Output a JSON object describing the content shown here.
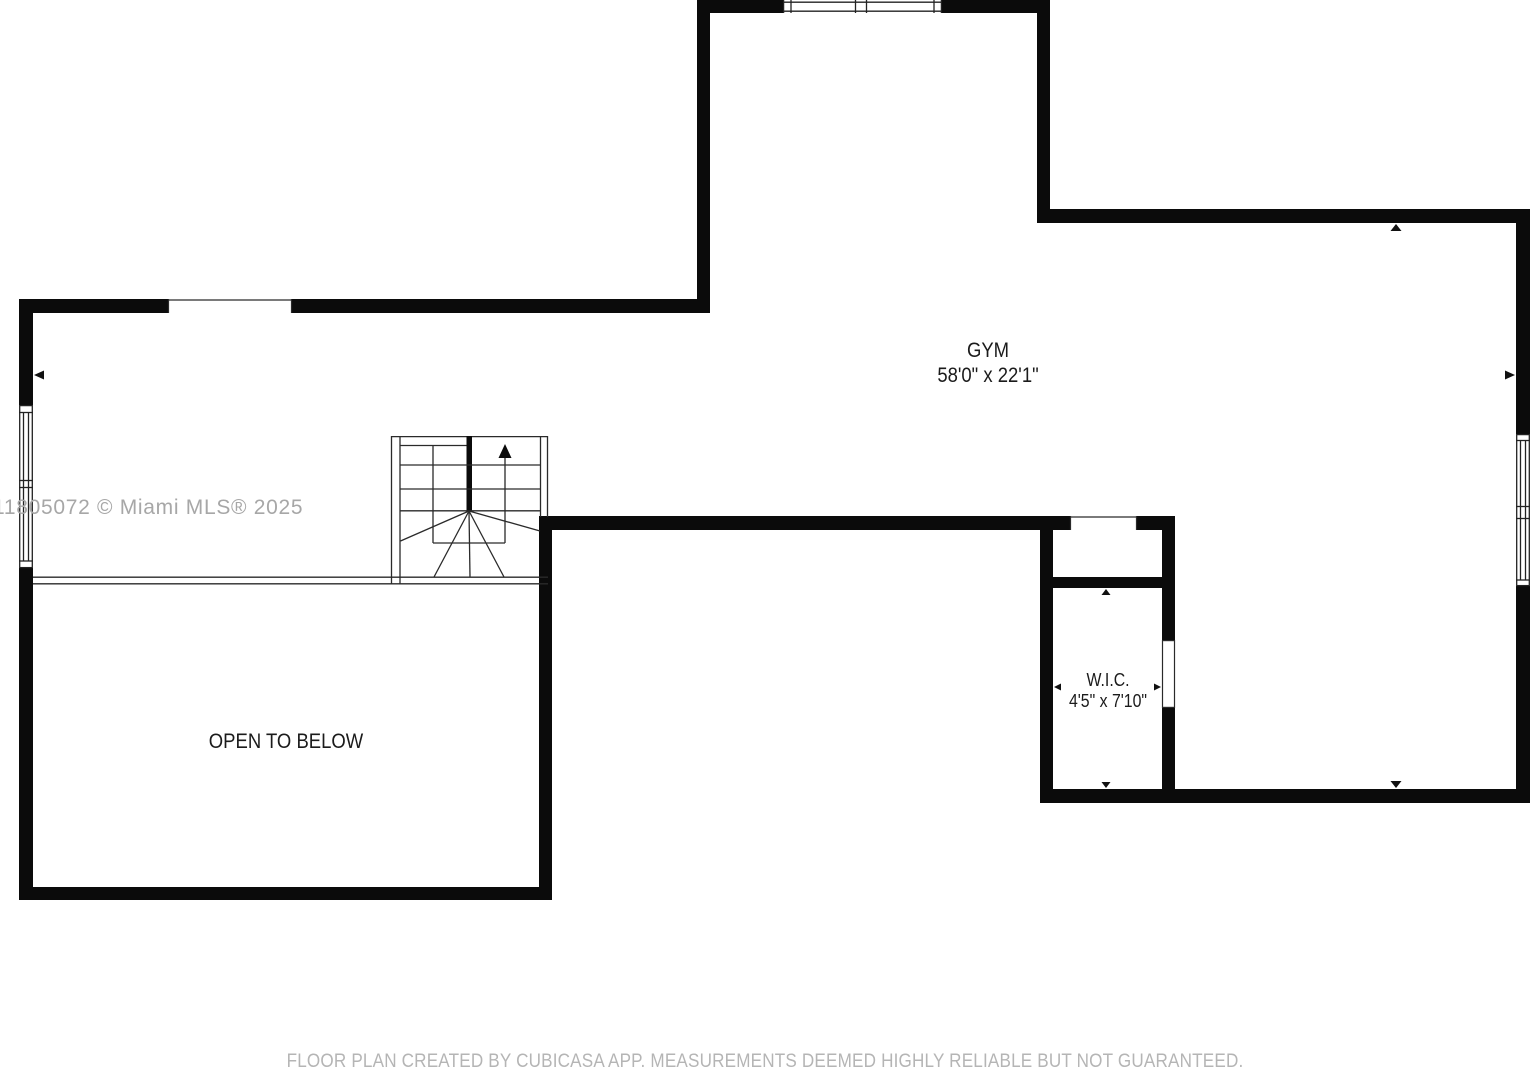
{
  "plan": {
    "type": "floor-plan",
    "floor_hint": "upper level (stairs up, open to below)"
  },
  "rooms": [
    {
      "name": "GYM",
      "dims": "58'0\" x 22'1\""
    },
    {
      "name": "OPEN TO BELOW",
      "dims": ""
    },
    {
      "name": "W.I.C.",
      "dims": "4'5\" x 7'10\""
    }
  ],
  "watermark": "11805072 © Miami MLS® 2025",
  "footer": "FLOOR PLAN CREATED BY CUBICASA APP. MEASUREMENTS DEEMED HIGHLY RELIABLE BUT NOT GUARANTEED.",
  "colors": {
    "wall": "#0b0b0b",
    "thin_line": "#222222",
    "label_text": "#1b1b1b",
    "watermark_text": "#a7a7a7",
    "footer_text": "#b5b5b5",
    "background": "#ffffff"
  },
  "icons": [
    "stair-up-arrow-icon",
    "dimension-arrow-left-icon",
    "dimension-arrow-right-icon",
    "dimension-arrow-up-icon",
    "dimension-arrow-down-icon"
  ]
}
